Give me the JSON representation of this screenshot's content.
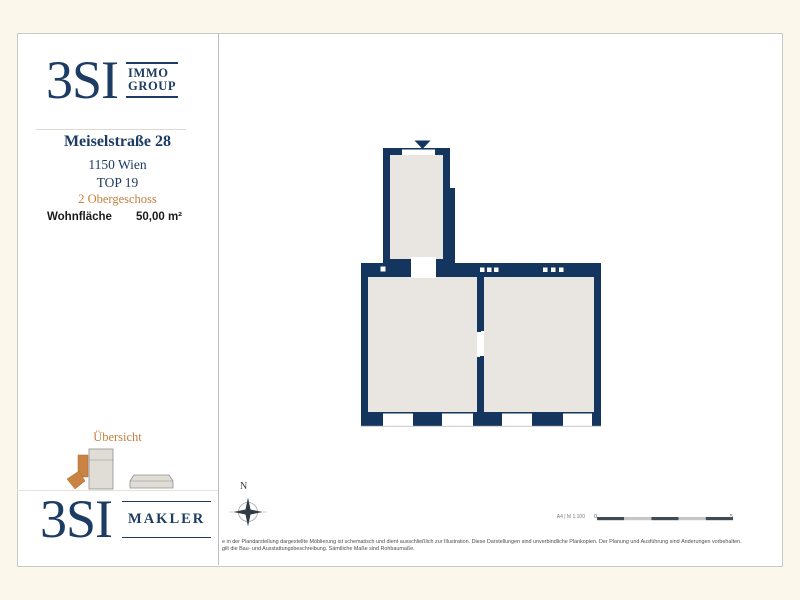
{
  "branding": {
    "logo_main": "3SI",
    "logo_top_sub_line1": "IMMO",
    "logo_top_sub_line2": "GROUP",
    "logo_bottom_sub": "MAKLER",
    "navy": "#1d3c63"
  },
  "property": {
    "street": "Meiselstraße 28",
    "city": "1150 Wien",
    "unit": "TOP 19",
    "floor": "2 Obergeschoss",
    "area_label": "Wohnfläche",
    "area_value": "50,00 m²"
  },
  "overview": {
    "title": "Übersicht"
  },
  "plan": {
    "compass_label": "N",
    "scale_label": "A4 | M 1:100",
    "scale_start": "0",
    "scale_end": "5",
    "wall_color": "#14355e",
    "floor_color": "#e9e5e0",
    "accent_orange": "#c5803f",
    "sheet_background": "#ffffff",
    "page_background": "#fbf7ea"
  },
  "disclaimer": {
    "line1": "e in der Plandarstellung dargestellte Möblierung ist schematisch und dient ausschließlich zur Illustration. Diese Darstellungen sind unverbindliche Plankopien. Der Planung und Ausführung sind Änderungen vorbehalten.",
    "line2": "gilt die Bau- und Ausstattungsbeschreibung. Sämtliche Maße sind Rohbaumaße."
  }
}
